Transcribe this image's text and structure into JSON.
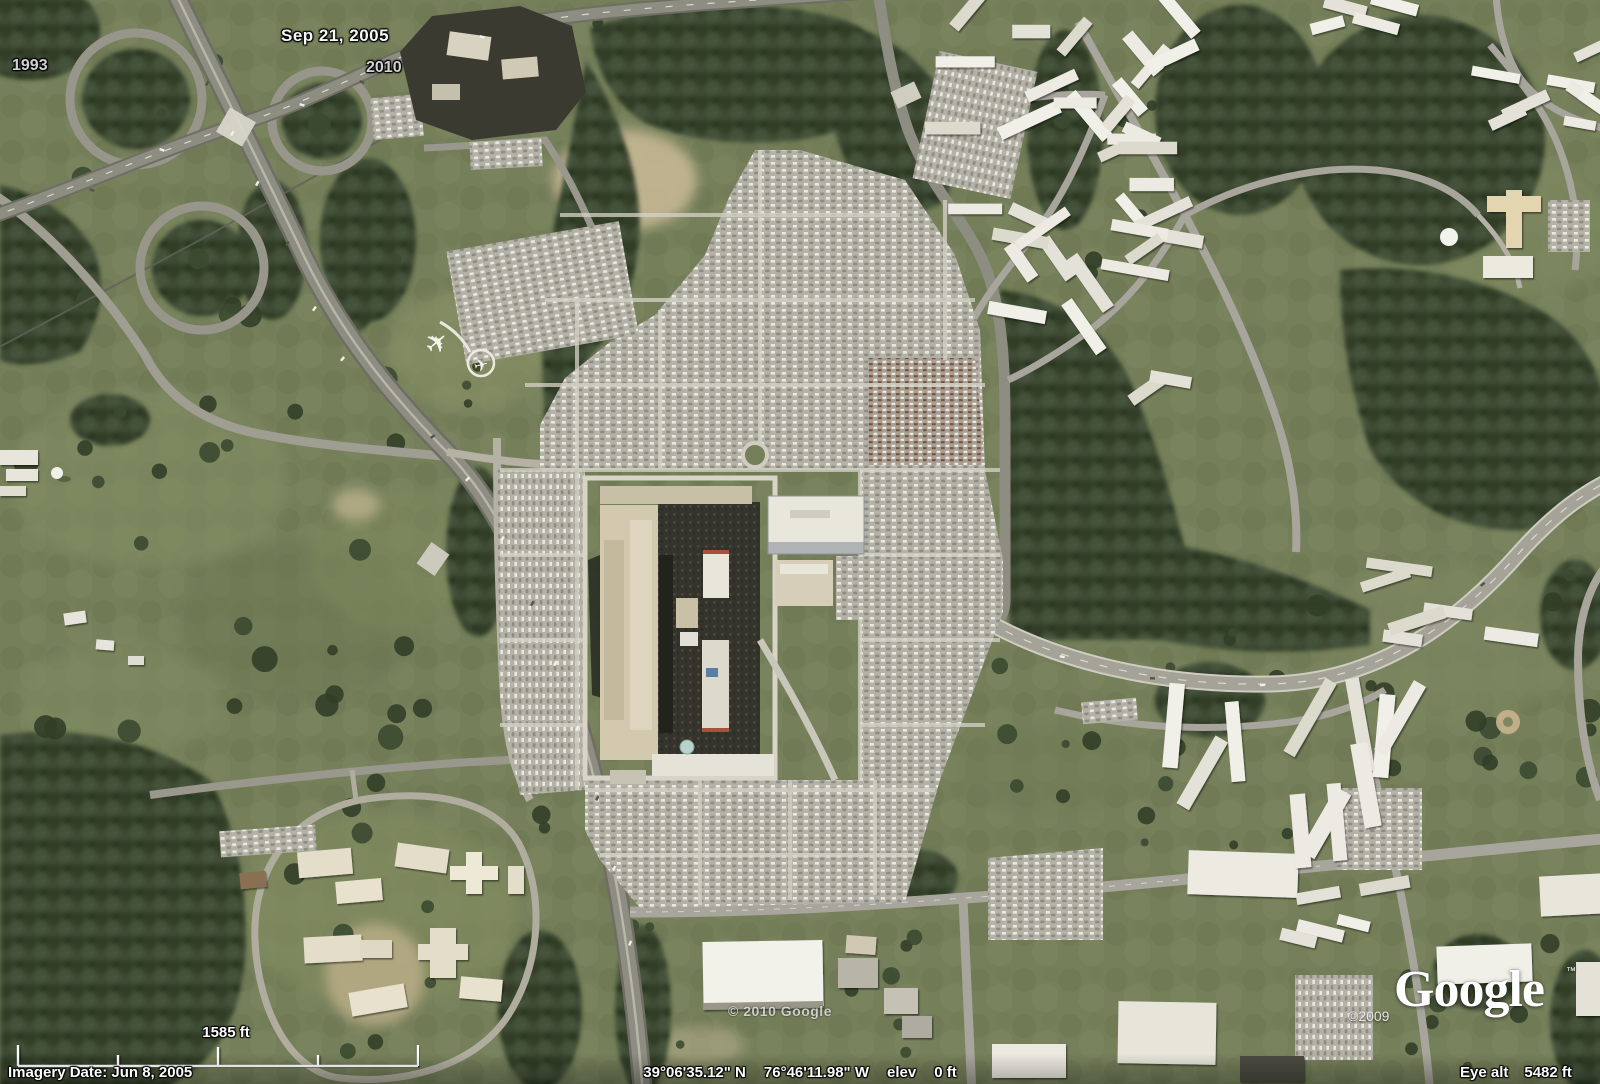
{
  "timeline": {
    "start_year": "1993",
    "current_date": "Sep 21, 2005",
    "end_year": "2010"
  },
  "scale_bar": {
    "label": "1585 ft"
  },
  "watermarks": {
    "center_copyright": "© 2010 Google",
    "logo_copyright": "©2009",
    "logo_text": "Google",
    "logo_trademark": "™"
  },
  "status_bar": {
    "imagery_date": "Imagery Date: Jun 8, 2005",
    "latitude": "39°06'35.12\" N",
    "longitude": "76°46'11.98\" W",
    "elev_label": "elev",
    "elevation": "0 ft",
    "eye_alt_label": "Eye alt",
    "eye_altitude": "5482 ft"
  }
}
